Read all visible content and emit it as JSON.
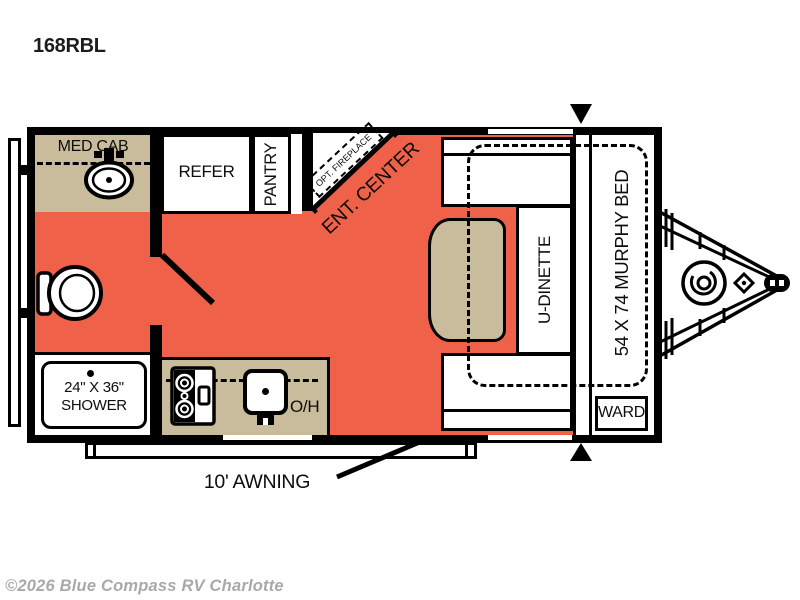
{
  "title": {
    "model": "168RBL"
  },
  "watermark": "©2026 Blue Compass RV Charlotte",
  "colors": {
    "floor_orange": "#EF6148",
    "cabinet_tan": "#C9BC9C",
    "line_black": "#000000",
    "watermark_gray": "#A9A9A9"
  },
  "rooms": {
    "med_cab": "MED CAB",
    "refer": "REFER",
    "pantry": "PANTRY",
    "opt_fireplace": "OPT. FIREPLACE",
    "ent_center": "ENT. CENTER",
    "u_dinette": "U-DINETTE",
    "murphy_bed": "54 X 74 MURPHY BED",
    "ward": "WARD",
    "shower": {
      "line1": "24\" X 36\"",
      "line2": "SHOWER"
    },
    "overhead": "O/H"
  },
  "exterior": {
    "awning": "10' AWNING"
  }
}
